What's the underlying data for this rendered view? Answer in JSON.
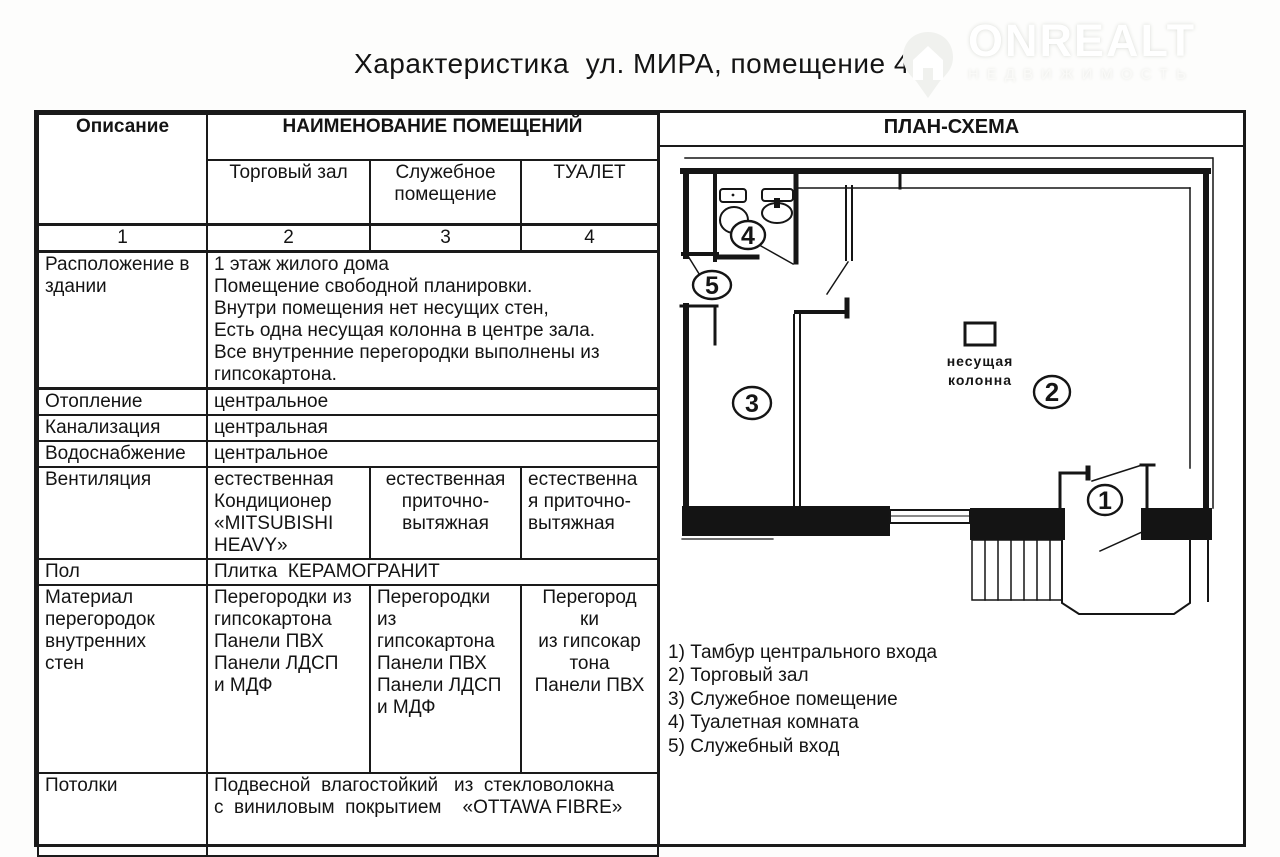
{
  "title": "Характеристика  ул. МИРА, помещение 43",
  "logo": {
    "brand": "ONREALT",
    "subtitle": "НЕДВИЖИМОСТЬ"
  },
  "table": {
    "desc_header": "Описание",
    "group_header": "НАИМЕНОВАНИЕ ПОМЕЩЕНИЙ",
    "columns": [
      "Торговый зал",
      "Служебное\nпомещение",
      "ТУАЛЕТ"
    ],
    "numbers": [
      "1",
      "2",
      "3",
      "4"
    ],
    "rows": [
      {
        "label": "Расположение в\nздании",
        "value": "1 этаж жилого дома\nПомещение свободной планировки.\nВнутри помещения нет несущих стен,\nЕсть одна несущая колонна в центре зала.\nВсе внутренние перегородки выполнены из\nгипсокартона."
      },
      {
        "label": "Отопление",
        "value": "центральное"
      },
      {
        "label": "Канализация",
        "value": "центральная"
      },
      {
        "label": "Водоснабжение",
        "value": "центральное"
      },
      {
        "label": "Вентиляция",
        "cells": [
          "естественная\nКондиционер\n«MITSUBISHI\nHEAVY»",
          "естественная\nприточно-\nвытяжная",
          "естественна\nя приточно-\nвытяжная"
        ]
      },
      {
        "label": "Пол",
        "value": "Плитка  КЕРАМОГРАНИТ"
      },
      {
        "label": "Материал\nперегородок\nвнутренних\nстен",
        "cells": [
          "Перегородки из\nгипсокартона\nПанели ПВХ\nПанели ЛДСП\nи МДФ",
          "Перегородки\nиз\nгипсокартона\nПанели ПВХ\nПанели ЛДСП\nи МДФ",
          "Перегород\nки\nиз гипсокар\nтона\nПанели ПВХ"
        ]
      },
      {
        "label": "Потолки",
        "value": "Подвесной  влагостойкий   из  стекловолокна\nс  виниловым  покрытием    «OTTAWA FIBRE»"
      }
    ]
  },
  "plan": {
    "header": "ПЛАН-СХЕМА",
    "column_label_1": "несущая",
    "column_label_2": "колонна",
    "markers": {
      "m1": "1",
      "m2": "2",
      "m3": "3",
      "m4": "4",
      "m5": "5"
    },
    "legend": [
      "1) Тамбур центрального входа",
      "2) Торговый зал",
      "3) Служебное помещение",
      "4) Туалетная комната",
      "5) Служебный вход"
    ]
  }
}
